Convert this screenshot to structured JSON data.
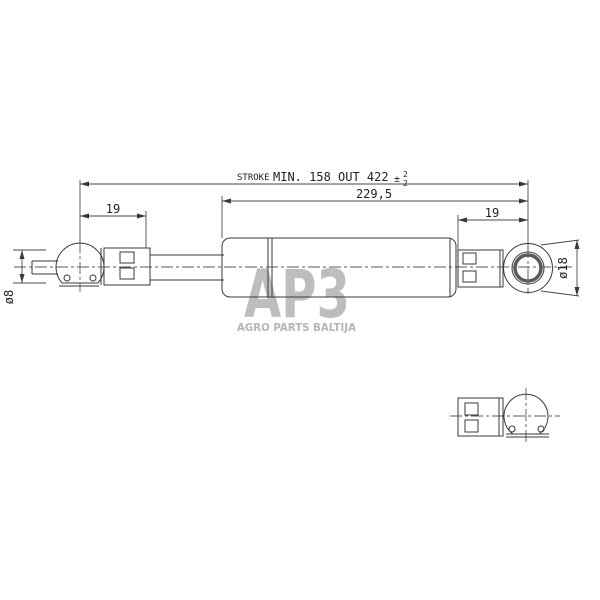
{
  "drawing": {
    "dims": {
      "stroke_prefix": "STROKE",
      "stroke_min": "MIN. 158",
      "stroke_out": "OUT 422",
      "tol_sign": "±",
      "tol_upper": "2",
      "tol_lower": "2",
      "total_length": "229,5",
      "left_offset": "19",
      "right_offset": "19",
      "left_diameter": "ø8",
      "right_diameter": "ø18"
    }
  },
  "watermark": {
    "logo": "AP3",
    "caption": "AGRO PARTS BALTIJA"
  },
  "colors": {
    "line": "#3a3a3a",
    "watermark": "#bdbdbd",
    "background": "#ffffff"
  }
}
